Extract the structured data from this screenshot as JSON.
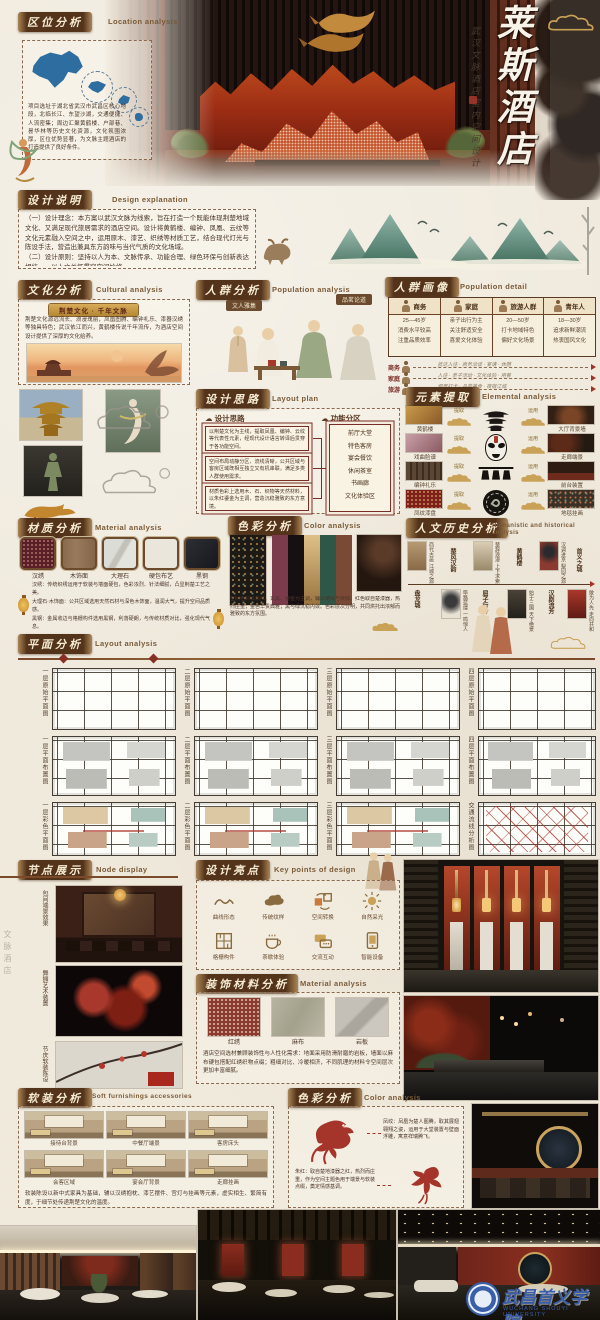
{
  "title_block": {
    "main": "莱斯酒店",
    "sub": "武汉文脉酒店室内空间设计"
  },
  "side_note": "文脉酒店",
  "location": {
    "title": "区位分析",
    "en": "Location analysis",
    "desc": "项目选址于湖北省武汉市武昌区核心地段，北临长江、东望沙湖，交通便捷、人流密集；周边汇聚黄鹤楼、户部巷、昙华林等历史文化资源，文化氛围浓厚，区位优势显著，为文脉主题酒店的打造提供了良好条件。"
  },
  "explain": {
    "title": "设计说明",
    "en": "Design explanation",
    "p1": "（一）设计理念：本方案以武汉文脉为线索，旨在打造一个既能体现荆楚地域文化、又满足现代旅居需求的酒店空间。设计将黄鹤楼、编钟、凤凰、云纹等文化元素融入空间之中，运用原木、漆艺、织绣等材质工艺，结合现代灯光与陈设手法，营造出兼具东方韵味与当代气质的文化场域。",
    "p2": "（二）设计原则：坚持以人为本、文脉传承、功能合理、绿色环保与创新表达相统一，以人文关怀贯穿空间始终。"
  },
  "culture": {
    "title": "文化分析",
    "en": "Cultural analysis",
    "badge": "荆楚文化 · 千年文脉",
    "desc": "荆楚文化源远流长、浪漫瑰丽，凤凰图腾、编钟礼乐、漆器汉绣等独具特色；武汉依江而兴，黄鹤楼传说千年流传，为酒店空间设计提供了深厚的文化给养。"
  },
  "population": {
    "title": "人群分析",
    "en": "Population analysis",
    "tag1": "文人雅集",
    "tag2": "品茗论道"
  },
  "portrait": {
    "title": "人群画像",
    "en": "Population detail",
    "columns": [
      {
        "label": "商务",
        "l1": "25—45岁",
        "l2": "消费水平较高",
        "l3": "注重品质效率"
      },
      {
        "label": "家庭",
        "l1": "亲子出行为主",
        "l2": "关注舒适安全",
        "l3": "喜爱文化体验"
      },
      {
        "label": "旅游人群",
        "l1": "20—50岁",
        "l2": "打卡地域特色",
        "l3": "偏好文化场景"
      },
      {
        "label": "青年人",
        "l1": "18—30岁",
        "l2": "追求新鲜潮流",
        "l3": "热衷国风文化"
      }
    ],
    "journeys": [
      {
        "label": "商务",
        "route": "抵达入住 · 商务洽谈 · 宴请 · 休憩"
      },
      {
        "label": "家庭",
        "route": "入住 · 亲子活动 · 文化体验 · 用餐"
      },
      {
        "label": "旅游",
        "route": "观景打卡 · 品尝美食 · 夜宿江城"
      }
    ]
  },
  "idea": {
    "title": "设计思路",
    "en": "Layout plan",
    "left_header": "设计思路",
    "right_header": "功能分区",
    "b1": "以荆楚文化为主线，提取凤凰、编钟、云纹等代表性元素，经现代设计语言转译后贯穿于各功能空间。",
    "b2": "空间布局动静分区、流线清晰，公共区域与客房区域既相互独立又有机串联，满足多类人群使用需求。",
    "b3": "材质色彩上选用木、石、织物等天然材料，以朱红鎏金为主调，营造沉稳雅致的东方意境。",
    "keywords": [
      "前厅大堂",
      "特色客房",
      "宴会餐饮",
      "休闲茶室",
      "书画廊",
      "文化体验区"
    ]
  },
  "extract": {
    "title": "元素提取",
    "en": "Elemental analysis",
    "extract_label": "提取",
    "apply_label": "运用",
    "rows": [
      {
        "src": "黄鹤楼",
        "dst": "大厅背景墙"
      },
      {
        "src": "戏曲脸谱",
        "dst": "走廊端景"
      },
      {
        "src": "编钟礼乐",
        "dst": "前台装置"
      },
      {
        "src": "凤纹漆盘",
        "dst": "地毯挂画"
      }
    ]
  },
  "material1": {
    "title": "材质分析",
    "en": "Material analysis",
    "swatches": [
      "汉绣",
      "木饰面",
      "大理石",
      "硬包布艺",
      "黑钢"
    ],
    "p1": "汉绣：传统织绣运用于软装与墙面硬包，色彩浓烈、针法细腻，凸显荆楚工艺之美。",
    "p2": "大理石·木饰面：公共区域选用天然石材与深色木饰面，温润大气，提升空间品质感。",
    "p3": "黑钢：金属收边与格栅构件选用黑钢，利落硬朗，与传统材质对比，强化现代气息。"
  },
  "color1": {
    "title": "色彩分析",
    "en": "Color analysis",
    "palette": [
      "#7b3b4c",
      "#171013",
      "#c7a96b",
      "#2f5747",
      "#7b4a36"
    ],
    "desc": "空间色彩以朱红、玄黑、鎏金为主调，辅以黛绿与栗棕：红色取自楚漆器，热烈庄重；金色华贵典雅；黑与绿沉稳内敛。色彩层次分明，共同烘托出浓郁而雅致的东方氛围。"
  },
  "history": {
    "title": "人文历史分析",
    "en": "Humanistic and historical analysis",
    "nodes": [
      {
        "name": "盘龙城",
        "note": "商代古邑 江城之源"
      },
      {
        "name": "楚风汉韵",
        "note": "筚路蓝缕 一鸣惊人"
      },
      {
        "name": "屈子行吟",
        "note": "楚辞浪漫 上下求索"
      },
      {
        "name": "黄鹤楼",
        "note": "始于三国 天下绝景"
      },
      {
        "name": "汉剧流芳",
        "note": "汉调进京 梨园之源"
      },
      {
        "name": "首义之城",
        "note": "敢为人先 走向共和"
      }
    ]
  },
  "plans": {
    "title": "平面分析",
    "en": "Layout analysis",
    "items": [
      {
        "caption": "一层原始平面图"
      },
      {
        "caption": "二层原始平面图"
      },
      {
        "caption": "三层原始平面图"
      },
      {
        "caption": "四层原始平面图"
      },
      {
        "caption": "一层平面布置图"
      },
      {
        "caption": "二层平面布置图"
      },
      {
        "caption": "三层平面布置图"
      },
      {
        "caption": "四层平面布置图"
      },
      {
        "caption": "一层彩色平面图"
      },
      {
        "caption": "二层彩色平面图"
      },
      {
        "caption": "三层彩色平面图"
      },
      {
        "caption": "交通流线分析图"
      }
    ]
  },
  "nodes": {
    "title": "节点展示",
    "en": "Node display",
    "items": [
      {
        "caption": "包间端景效果"
      },
      {
        "caption": "舞狮艺术装置"
      },
      {
        "caption": "节庆软装陈设"
      }
    ]
  },
  "highlight": {
    "title": "设计亮点",
    "en": "Key points of design",
    "items": [
      {
        "label": "曲线形态"
      },
      {
        "label": "传统纹样"
      },
      {
        "label": "空间转换"
      },
      {
        "label": "自然采光"
      },
      {
        "label": "格栅构件"
      },
      {
        "label": "茶歇体验"
      },
      {
        "label": "交流互动"
      },
      {
        "label": "智能设备"
      }
    ]
  },
  "material2": {
    "title": "装饰材料分析",
    "en": "Material analysis",
    "swatches": [
      "红绣",
      "麻布",
      "岩板"
    ],
    "desc": "酒店空间选材兼顾装饰性与人性化需求：地面采用防滑耐磨的岩板，墙面以麻布硬包搭配红绣织物点缀；粗细对比、冷暖相济，不同肌理的材料令空间层次更加丰富细腻。"
  },
  "soft": {
    "title": "软装分析",
    "en": "Soft furnishings accessories",
    "thumbs": [
      "接待台背景",
      "中餐厅端景",
      "客房床头",
      "会客区域",
      "宴会厅背景",
      "走廊挂画"
    ],
    "desc": "软装陈设以新中式家具为基础，辅以汉绣抱枕、漆艺摆件、宫灯与挂画等元素，虚实相生、繁简有度，于细节处传递荆楚文化的温度。"
  },
  "color2": {
    "title": "色彩分析",
    "en": "Color analysis",
    "note1": "凤纹：凤凰为楚人图腾，取其展翅翱翔之姿，运用于大堂装置与壁面浮雕，寓意祥瑞腾飞。",
    "note2": "朱红：取自楚地漆器之红，热烈而庄重，作为空间主题色用于端景与软装点缀，奠定情感基调。"
  },
  "footer": {
    "school": "武昌首义学院",
    "school_en": "WUCHANG SHOUYI UNIVERSITY"
  }
}
